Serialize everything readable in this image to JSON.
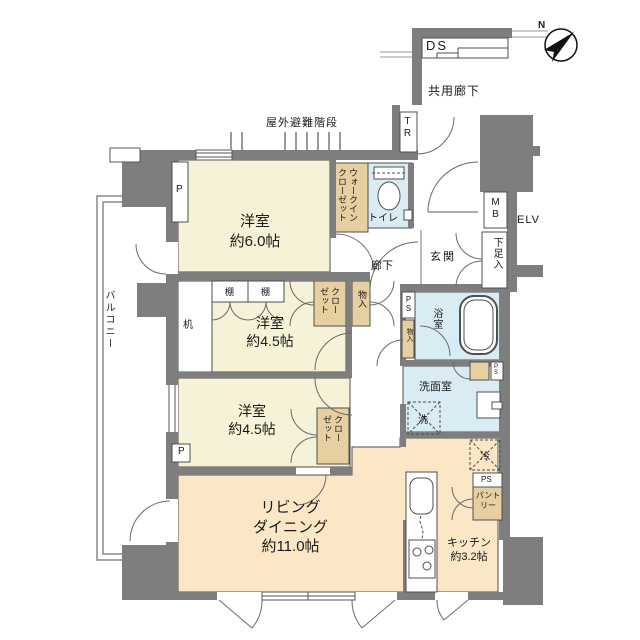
{
  "floor_plan": {
    "compass": "N",
    "exterior": {
      "duct_space": "DS",
      "common_corridor": "共用廊下",
      "trunk_room": "TR",
      "evacuation_stairs": "屋外避難階段",
      "elevator": "ELV",
      "meter_box": "MB",
      "balcony": "バルコニー"
    },
    "rooms": {
      "bedroom_6": {
        "name": "洋室",
        "size": "約6.0帖"
      },
      "bedroom_45a": {
        "name": "洋室",
        "size": "約4.5帖"
      },
      "bedroom_45b": {
        "name": "洋室",
        "size": "約4.5帖"
      },
      "living_dining": {
        "name1": "リビング",
        "name2": "ダイニング",
        "size": "約11.0帖"
      },
      "kitchen": {
        "name": "キッチン",
        "size": "約3.2帖"
      },
      "entrance": "玄関",
      "hallway": "廊下",
      "toilet": "トイレ",
      "bathroom": "浴室",
      "washroom": "洗面室"
    },
    "storage": {
      "walk_in_closet": "ウォークインクローゼット",
      "closet_a": "クローゼット",
      "closet_b": "クローゼット",
      "storage_a": "物入",
      "storage_b": "物入",
      "shoe_cabinet": "下足入",
      "pantry": "パントリー",
      "shelf_a": "棚",
      "shelf_b": "棚",
      "desk": "机"
    },
    "equipment": {
      "washer": "洗",
      "fridge": "冷",
      "pipe_space_a": "PS",
      "pipe_space_b": "PS",
      "pipe_space_c": "PS",
      "pipe_a": "P",
      "pipe_b": "P"
    },
    "colors": {
      "wall": "#7e7e7e",
      "room_cream": "#f5f2d7",
      "room_peach": "#fbe7c5",
      "wet_blue": "#d9ecf4",
      "closet_tan": "#e6cfa0"
    }
  }
}
